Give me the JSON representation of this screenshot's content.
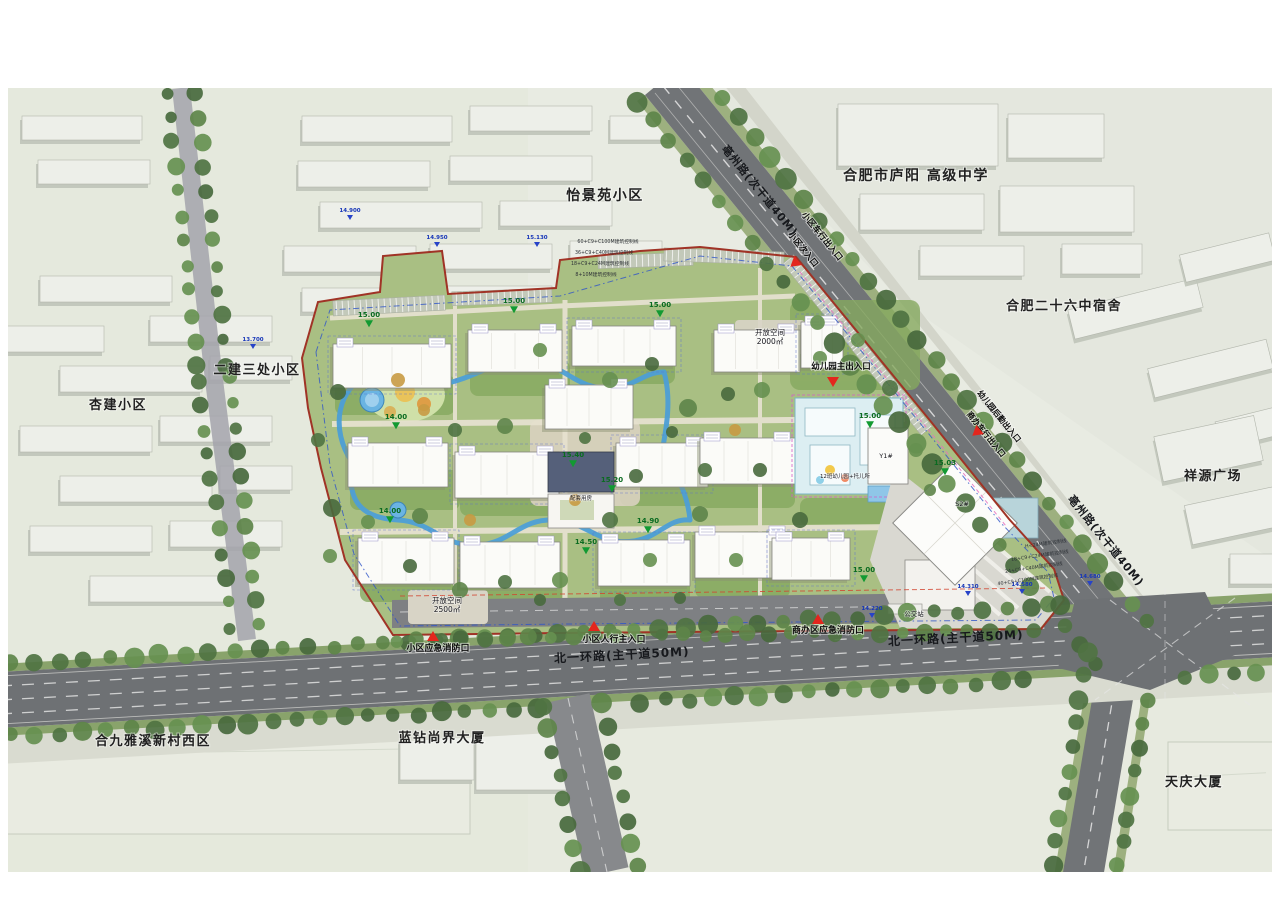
{
  "colors": {
    "boundary_red": "#a03326",
    "entrance_red": "#e3261d",
    "water_blue": "#4d9fd6",
    "asphalt": "#6e7174",
    "site_green": "#a9bf83",
    "elevation_green": "#129a32",
    "elevation_blue": "#2743c8"
  },
  "map": {
    "surrounding_labels": [
      {
        "name": "area-label-yijingyuan",
        "text": "怡景苑小区",
        "x": 605,
        "y": 200,
        "size": 14
      },
      {
        "name": "area-label-luyang-highschool",
        "text": "合肥市庐阳 高级中学",
        "x": 916,
        "y": 180,
        "size": 14
      },
      {
        "name": "area-label-no26-dorm",
        "text": "合肥二十六中宿舍",
        "x": 1064,
        "y": 310,
        "size": 13
      },
      {
        "name": "area-label-xiangyuan-plaza",
        "text": "祥源广场",
        "x": 1213,
        "y": 480,
        "size": 13
      },
      {
        "name": "area-label-erjiansanchu",
        "text": "二建三处小区",
        "x": 257,
        "y": 374,
        "size": 13
      },
      {
        "name": "area-label-xingjian",
        "text": "杏建小区",
        "x": 118,
        "y": 409,
        "size": 13
      },
      {
        "name": "area-label-hejiu-yaxi-west",
        "text": "合九雅溪新村西区",
        "x": 153,
        "y": 745,
        "size": 13
      },
      {
        "name": "area-label-lanzuan-shangjie",
        "text": "蓝钻尚界大厦",
        "x": 442,
        "y": 742,
        "size": 13
      },
      {
        "name": "area-label-tianqing-tower",
        "text": "天庆大厦",
        "x": 1194,
        "y": 786,
        "size": 13
      }
    ],
    "road_labels": [
      {
        "name": "road-label-bozhou-north",
        "text": "亳州路(次干道40M)",
        "x": 757,
        "y": 193,
        "rot": 51,
        "size": 11
      },
      {
        "name": "road-label-bozhou-south",
        "text": "亳州路(次干道40M)",
        "x": 1103,
        "y": 543,
        "rot": 51,
        "size": 11
      },
      {
        "name": "road-label-beiyihuan-west",
        "text": "北一环路(主干道50M)",
        "x": 622,
        "y": 659,
        "rot": -3,
        "size": 12
      },
      {
        "name": "road-label-beiyihuan-east",
        "text": "北一环路(主干道50M)",
        "x": 956,
        "y": 642,
        "rot": -3,
        "size": 12
      }
    ],
    "entrances": [
      {
        "name": "entrance-vehicle-gate",
        "text": "小区车行出入口",
        "x": 820,
        "y": 238,
        "rot": 51,
        "size": 8.5
      },
      {
        "name": "entrance-secondary-gate",
        "text": "小区次入口",
        "x": 801,
        "y": 251,
        "rot": 51,
        "size": 8.5,
        "marker": {
          "x": 795,
          "y": 263,
          "rot": 51
        }
      },
      {
        "name": "entrance-kindergarten-main",
        "text": "幼儿园主出入口",
        "x": 841,
        "y": 369,
        "size": 8.5,
        "marker": {
          "x": 833,
          "y": 381,
          "rot": 0
        }
      },
      {
        "name": "entrance-kindergarten-service",
        "text": "幼儿园后勤出入口",
        "x": 997,
        "y": 418,
        "rot": 51,
        "size": 8
      },
      {
        "name": "entrance-commercial-vehicle",
        "text": "商办车行出入口",
        "x": 984,
        "y": 436,
        "rot": 51,
        "size": 8,
        "marker": {
          "x": 977,
          "y": 432,
          "rot": 51
        }
      },
      {
        "name": "entrance-fire-emergency-west",
        "text": "小区应急消防口",
        "x": 438,
        "y": 651,
        "size": 9,
        "marker": {
          "x": 433,
          "y": 637,
          "rot": 180
        }
      },
      {
        "name": "entrance-pedestrian-main",
        "text": "小区人行主入口",
        "x": 614,
        "y": 642,
        "size": 9,
        "marker": {
          "x": 594,
          "y": 627,
          "rot": 180
        }
      },
      {
        "name": "entrance-commercial-fire",
        "text": "商办区应急消防口",
        "x": 828,
        "y": 633,
        "size": 9,
        "marker": {
          "x": 818,
          "y": 620,
          "rot": 180
        }
      }
    ],
    "site_labels": [
      {
        "name": "open-space-south-title",
        "text": "开放空间",
        "x": 447,
        "y": 603,
        "size": 7.5
      },
      {
        "name": "open-space-south-area",
        "text": "2500㎡",
        "x": 447,
        "y": 612,
        "size": 7.5
      },
      {
        "name": "open-space-east-title",
        "text": "开放空间",
        "x": 770,
        "y": 335,
        "size": 7.5
      },
      {
        "name": "open-space-east-area",
        "text": "2000㎡",
        "x": 770,
        "y": 344,
        "size": 7.5
      },
      {
        "name": "bus-stop-label",
        "text": "公交站",
        "x": 914,
        "y": 616,
        "size": 6.5
      },
      {
        "name": "kindergarten-label",
        "text": "12班幼儿园+托儿所",
        "x": 845,
        "y": 478,
        "size": 5.5
      },
      {
        "name": "building-y1-label",
        "text": "Y1#",
        "x": 886,
        "y": 458,
        "size": 6.5
      },
      {
        "name": "building-s2-label",
        "text": "S2#",
        "x": 962,
        "y": 506,
        "size": 6.5
      },
      {
        "name": "service-house-label",
        "text": "配套用房",
        "x": 581,
        "y": 500,
        "size": 5.5
      }
    ],
    "annotations": [
      {
        "name": "control-line-1",
        "text": "60+C9+C100M建筑控制线",
        "x": 608,
        "y": 243,
        "size": 4.8
      },
      {
        "name": "control-line-2",
        "text": "36+C9+C40M建筑控制线",
        "x": 604,
        "y": 254,
        "size": 4.8
      },
      {
        "name": "control-line-3",
        "text": "18+C9+C24M建筑控制线",
        "x": 600,
        "y": 265,
        "size": 4.8
      },
      {
        "name": "control-line-4",
        "text": "8+10M建筑控制线",
        "x": 596,
        "y": 276,
        "size": 4.8
      },
      {
        "name": "control-line-5",
        "text": "H<24M建筑控制线",
        "x": 1046,
        "y": 545,
        "size": 4.8,
        "rot": -8
      },
      {
        "name": "control-line-6",
        "text": "18+C9+C24M建筑控制线",
        "x": 1040,
        "y": 557,
        "size": 4.8,
        "rot": -8
      },
      {
        "name": "control-line-7",
        "text": "24+C9+C40M建筑控制线",
        "x": 1034,
        "y": 569,
        "size": 4.8,
        "rot": -8
      },
      {
        "name": "control-line-8",
        "text": "40+C9+C100M建筑控制线",
        "x": 1028,
        "y": 581,
        "size": 4.8,
        "rot": -8
      }
    ],
    "elevations": {
      "green": [
        {
          "v": "15.00",
          "x": 369,
          "y": 321
        },
        {
          "v": "15.00",
          "x": 514,
          "y": 307
        },
        {
          "v": "15.00",
          "x": 660,
          "y": 311
        },
        {
          "v": "14.00",
          "x": 396,
          "y": 423
        },
        {
          "v": "14.00",
          "x": 390,
          "y": 517
        },
        {
          "v": "15.40",
          "x": 573,
          "y": 461
        },
        {
          "v": "15.20",
          "x": 612,
          "y": 486
        },
        {
          "v": "14.90",
          "x": 648,
          "y": 527
        },
        {
          "v": "14.50",
          "x": 586,
          "y": 548
        },
        {
          "v": "15.00",
          "x": 870,
          "y": 422
        },
        {
          "v": "15.03",
          "x": 945,
          "y": 469
        },
        {
          "v": "15.00",
          "x": 864,
          "y": 576
        }
      ],
      "blue": [
        {
          "v": "14.900",
          "x": 350,
          "y": 215
        },
        {
          "v": "14.950",
          "x": 437,
          "y": 242
        },
        {
          "v": "15.130",
          "x": 537,
          "y": 242
        },
        {
          "v": "13.700",
          "x": 253,
          "y": 344
        },
        {
          "v": "14.680",
          "x": 1090,
          "y": 581
        },
        {
          "v": "14.580",
          "x": 1022,
          "y": 589
        },
        {
          "v": "14.310",
          "x": 968,
          "y": 591
        },
        {
          "v": "14.220",
          "x": 872,
          "y": 613
        }
      ]
    }
  }
}
